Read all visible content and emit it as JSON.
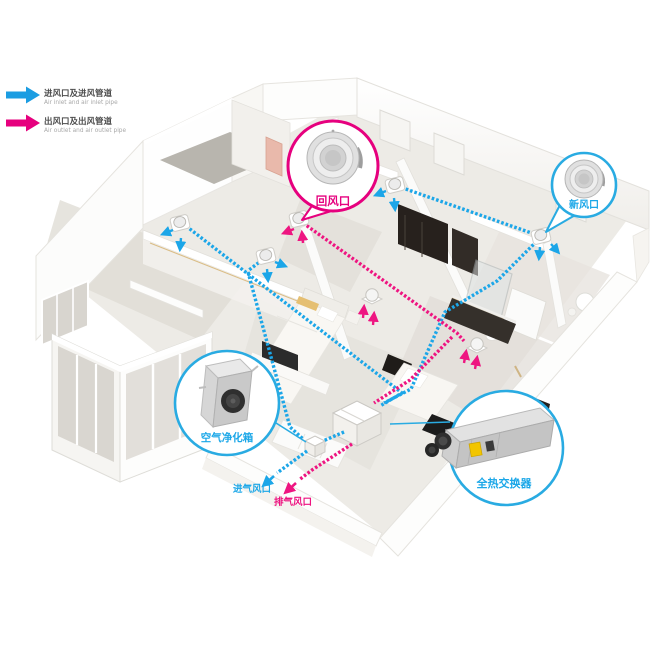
{
  "legend": {
    "items": [
      {
        "label_cn": "进风口及进风管道",
        "label_en": "Air inlet and air inlet pipe",
        "color": "#1b9de2"
      },
      {
        "label_cn": "出风口及出风管道",
        "label_en": "Air outlet and air outlet pipe",
        "color": "#e6007e"
      }
    ]
  },
  "callouts": {
    "return_air": {
      "label": "回风口",
      "color": "#e6007e"
    },
    "fresh_air": {
      "label": "新风口",
      "color": "#29abe2"
    },
    "air_purifier": {
      "label": "空气净化箱",
      "color": "#29abe2"
    },
    "heat_exchanger": {
      "label": "全热交换器",
      "color": "#29abe2"
    }
  },
  "ports": {
    "intake": {
      "label": "进气风口",
      "color": "#1ba7e8"
    },
    "exhaust": {
      "label": "排气风口",
      "color": "#ed1380"
    }
  },
  "colors": {
    "supply_pipe": "#1ca6e8",
    "exhaust_pipe": "#ee1581",
    "callout_blue": "#29abe2",
    "callout_pink": "#e6007e"
  }
}
